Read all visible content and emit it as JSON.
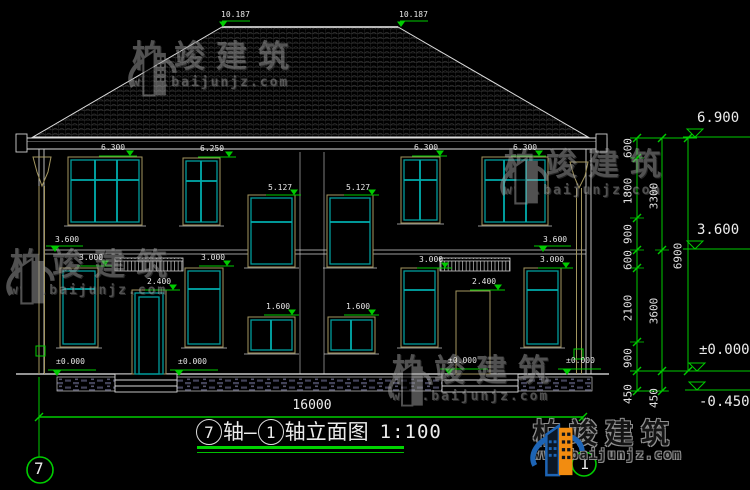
{
  "drawing": {
    "title": {
      "bubble_left": "7",
      "segment_1": "轴—",
      "bubble_right": "1",
      "segment_2": "轴立面图",
      "scale": "1:100"
    },
    "axis_bubble_bottom_left": "7",
    "axis_bubble_bottom_right": "1",
    "overall_width_dim": "16000"
  },
  "watermark": {
    "brand": "柏竣建筑",
    "site": "www.baijunjz.com"
  },
  "logo": {
    "brand": "柏竣建筑",
    "site": "www.baijunjz.com"
  },
  "colors": {
    "line": "#dcdcdc",
    "window": "#009c9c",
    "frame": "#a39660",
    "dimension": "#00cc00",
    "background": "#000000"
  },
  "annotations": {
    "spot_elevations": [
      {
        "t": "10.187",
        "tx": 221,
        "ty": 11,
        "l1": 222,
        "l2": 250,
        "ly": 21,
        "ax": 223,
        "ay": 27
      },
      {
        "t": "10.187",
        "tx": 399,
        "ty": 11,
        "l1": 400,
        "l2": 428,
        "ly": 21,
        "ax": 401,
        "ay": 27
      },
      {
        "t": "6.300",
        "tx": 101,
        "ty": 144,
        "l1": 99,
        "l2": 137,
        "ly": 156,
        "ax": 130,
        "ay": 156
      },
      {
        "t": "6.250",
        "tx": 200,
        "ty": 145,
        "l1": 198,
        "l2": 236,
        "ly": 157,
        "ax": 229,
        "ay": 157
      },
      {
        "t": "5.127",
        "tx": 268,
        "ty": 184,
        "l1": 266,
        "l2": 301,
        "ly": 195,
        "ax": 294,
        "ay": 195
      },
      {
        "t": "5.127",
        "tx": 346,
        "ty": 184,
        "l1": 344,
        "l2": 379,
        "ly": 195,
        "ax": 372,
        "ay": 195
      },
      {
        "t": "6.300",
        "tx": 414,
        "ty": 144,
        "l1": 412,
        "l2": 447,
        "ly": 156,
        "ax": 440,
        "ay": 156
      },
      {
        "t": "6.300",
        "tx": 513,
        "ty": 144,
        "l1": 511,
        "l2": 546,
        "ly": 156,
        "ax": 539,
        "ay": 156
      },
      {
        "t": "3.600",
        "tx": 55,
        "ty": 236,
        "l1": 46,
        "l2": 83,
        "ly": 246,
        "ax": 55,
        "ay": 252
      },
      {
        "t": "3.600",
        "tx": 543,
        "ty": 236,
        "l1": 534,
        "l2": 571,
        "ly": 246,
        "ax": 543,
        "ay": 252
      },
      {
        "t": "3.000",
        "tx": 79,
        "ty": 254,
        "l1": 77,
        "l2": 112,
        "ly": 266,
        "ax": 105,
        "ay": 266
      },
      {
        "t": "3.000",
        "tx": 201,
        "ty": 254,
        "l1": 199,
        "l2": 234,
        "ly": 266,
        "ax": 227,
        "ay": 266
      },
      {
        "t": "3.000",
        "tx": 419,
        "ty": 256,
        "l1": 417,
        "l2": 452,
        "ly": 268,
        "ax": 445,
        "ay": 268
      },
      {
        "t": "3.000",
        "tx": 540,
        "ty": 256,
        "l1": 538,
        "l2": 573,
        "ly": 268,
        "ax": 566,
        "ay": 268
      },
      {
        "t": "2.400",
        "tx": 147,
        "ty": 278,
        "l1": 145,
        "l2": 180,
        "ly": 290,
        "ax": 173,
        "ay": 290
      },
      {
        "t": "2.400",
        "tx": 472,
        "ty": 278,
        "l1": 470,
        "l2": 505,
        "ly": 290,
        "ax": 498,
        "ay": 290
      },
      {
        "t": "1.600",
        "tx": 266,
        "ty": 303,
        "l1": 264,
        "l2": 299,
        "ly": 315,
        "ax": 292,
        "ay": 315
      },
      {
        "t": "1.600",
        "tx": 346,
        "ty": 303,
        "l1": 344,
        "l2": 379,
        "ly": 315,
        "ax": 372,
        "ay": 315
      },
      {
        "t": "±0.000",
        "tx": 56,
        "ty": 358,
        "l1": 48,
        "l2": 96,
        "ly": 370,
        "ax": 57,
        "ay": 376
      },
      {
        "t": "±0.000",
        "tx": 178,
        "ty": 358,
        "l1": 170,
        "l2": 218,
        "ly": 370,
        "ax": 179,
        "ay": 376
      },
      {
        "t": "±0.000",
        "tx": 448,
        "ty": 357,
        "l1": 440,
        "l2": 488,
        "ly": 369,
        "ax": 449,
        "ay": 375
      },
      {
        "t": "±0.000",
        "tx": 566,
        "ty": 357,
        "l1": 558,
        "l2": 601,
        "ly": 369,
        "ax": 567,
        "ay": 375
      }
    ],
    "right_levels": [
      {
        "t": "6.900",
        "tx": 697,
        "ty": 111,
        "ly": 137
      },
      {
        "t": "3.600",
        "tx": 697,
        "ty": 223,
        "ly": 249
      },
      {
        "t": "±0.000",
        "tx": 699,
        "ty": 343,
        "ly": 371
      },
      {
        "t": "-0.450",
        "tx": 699,
        "ty": 395,
        "ly": 390
      }
    ],
    "chain_dims": [
      {
        "t": "600",
        "x": 628,
        "y": 148
      },
      {
        "t": "1800",
        "x": 628,
        "y": 191
      },
      {
        "t": "900",
        "x": 628,
        "y": 234
      },
      {
        "t": "600",
        "x": 628,
        "y": 260
      },
      {
        "t": "2100",
        "x": 628,
        "y": 308
      },
      {
        "t": "900",
        "x": 628,
        "y": 358
      },
      {
        "t": "450",
        "x": 628,
        "y": 394
      },
      {
        "t": "3300",
        "x": 654,
        "y": 196
      },
      {
        "t": "3600",
        "x": 654,
        "y": 311
      },
      {
        "t": "450",
        "x": 654,
        "y": 398
      },
      {
        "t": "6900",
        "x": 678,
        "y": 256
      }
    ]
  }
}
